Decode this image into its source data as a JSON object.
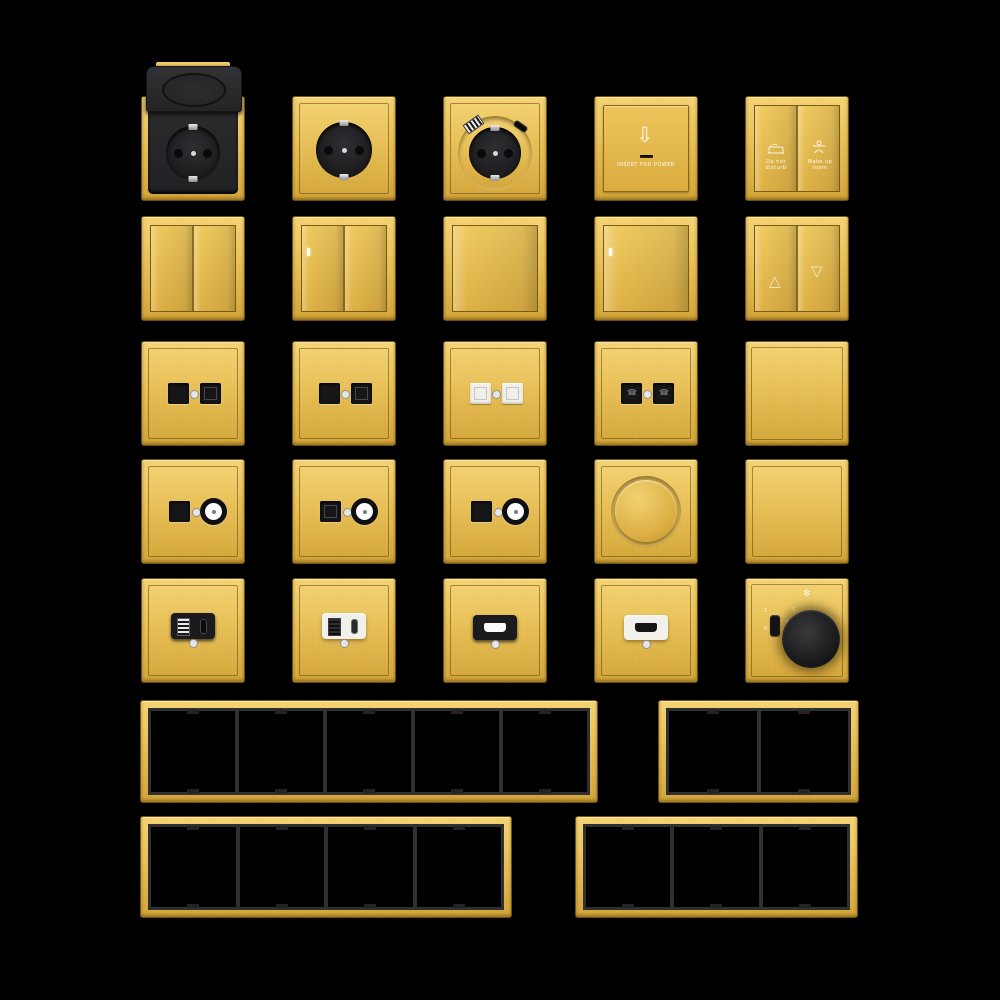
{
  "palette": {
    "background": "#000000",
    "gold": "#e7bf55",
    "gold_light": "#f4d373",
    "gold_dark": "#d2a437",
    "gold_edge": "#6d5312",
    "module_black": "#1b1b1d",
    "module_white": "#f1efe9",
    "frame_lining": "#303033",
    "indicator_led": "#ffffff"
  },
  "labels": {
    "card_holder": "INSERT FOR POWER",
    "do_not_disturb": "Do not disturb",
    "make_up_room": "Make up room",
    "fan_on": "1",
    "fan_off": "0",
    "fan_mark_5": "5",
    "fan_mark_4": "4",
    "fan_mark_3": "3",
    "fan_mark_2": "2"
  },
  "icons": {
    "down_arrow": "⇩",
    "up_triangle": "△",
    "down_triangle": "▽",
    "phone": "☎",
    "fan": "✻",
    "snowflake": "❄",
    "do_not_disturb_icon": "bed",
    "make_up_room_icon": "housekeeper"
  },
  "products": [
    {
      "name": "schuko-socket-with-flip-cover",
      "finish": "brushed gold",
      "detail": "black insert, hinged cover open"
    },
    {
      "name": "schuko-socket",
      "finish": "brushed gold",
      "detail": "black round outlet"
    },
    {
      "name": "schuko-socket-usb-charger",
      "finish": "brushed gold",
      "detail": "USB-A and USB-C ports above outlet"
    },
    {
      "name": "key-card-power-switch",
      "finish": "brushed gold",
      "detail": "arrow, card slot, caption"
    },
    {
      "name": "do-not-disturb-make-up-room-switch",
      "finish": "brushed gold",
      "detail": "two rockers with hotel icons"
    },
    {
      "name": "2-gang-rocker-switch",
      "finish": "brushed gold"
    },
    {
      "name": "2-gang-rocker-switch-with-indicator",
      "finish": "brushed gold",
      "detail": "white LED top-left"
    },
    {
      "name": "1-gang-rocker-switch",
      "finish": "brushed gold"
    },
    {
      "name": "1-gang-rocker-switch-with-indicator",
      "finish": "brushed gold",
      "detail": "white LED top-left"
    },
    {
      "name": "curtain-blind-switch",
      "finish": "brushed gold",
      "detail": "up and down triangle rockers"
    },
    {
      "name": "dual-data-socket-black",
      "finish": "brushed gold",
      "detail": "blank + keystone jack"
    },
    {
      "name": "dual-data-socket-black-2",
      "finish": "brushed gold",
      "detail": "blank + keystone jack"
    },
    {
      "name": "dual-data-socket-white",
      "finish": "brushed gold",
      "detail": "two white keystone jacks"
    },
    {
      "name": "dual-phone-socket-black",
      "finish": "brushed gold",
      "detail": "two black jacks with icons"
    },
    {
      "name": "blank-plate",
      "finish": "brushed gold"
    },
    {
      "name": "data-tv-socket-1",
      "finish": "brushed gold",
      "detail": "black jack + coax connector"
    },
    {
      "name": "data-tv-socket-2",
      "finish": "brushed gold",
      "detail": "keystone jack + coax connector"
    },
    {
      "name": "data-tv-socket-3",
      "finish": "brushed gold",
      "detail": "black jack + coax connector"
    },
    {
      "name": "rotary-dimmer",
      "finish": "brushed gold",
      "detail": "round gold knob"
    },
    {
      "name": "blank-plate-2",
      "finish": "brushed gold"
    },
    {
      "name": "usb-a-c-charger-black",
      "finish": "brushed gold",
      "detail": "black module, USB-A + USB-C"
    },
    {
      "name": "usb-a-c-charger-white",
      "finish": "brushed gold",
      "detail": "white module, USB-A + USB-C"
    },
    {
      "name": "hdmi-socket-black",
      "finish": "brushed gold",
      "detail": "black module, HDMI port"
    },
    {
      "name": "hdmi-socket-white",
      "finish": "brushed gold",
      "detail": "white module, HDMI port"
    },
    {
      "name": "fan-speed-controller",
      "finish": "brushed gold",
      "detail": "black knob, 0/1 toggle, marks 2-5, fan and snowflake symbols"
    }
  ],
  "frames": [
    {
      "name": "frame-5-gang",
      "gangs": 5
    },
    {
      "name": "frame-2-gang",
      "gangs": 2
    },
    {
      "name": "frame-4-gang",
      "gangs": 4
    },
    {
      "name": "frame-3-gang",
      "gangs": 3
    }
  ]
}
